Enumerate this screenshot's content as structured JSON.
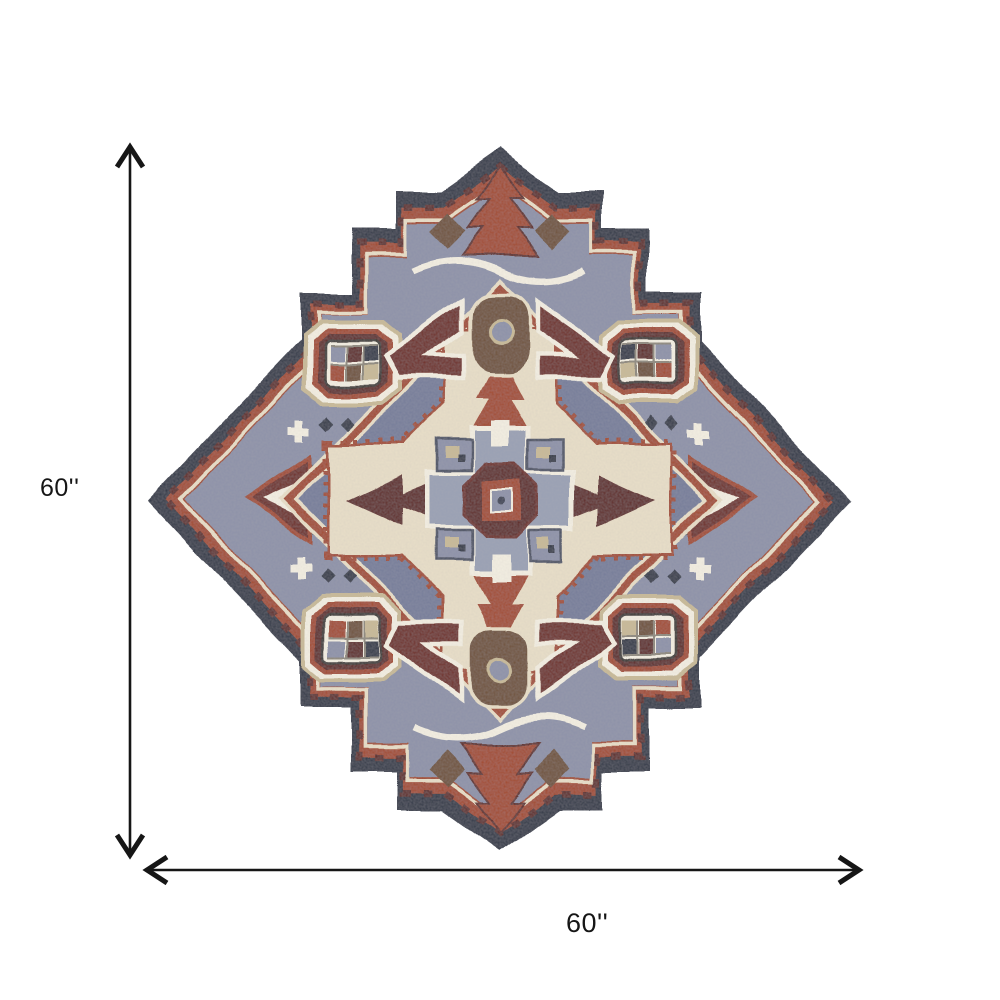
{
  "dimensions": {
    "height_label": "60''",
    "width_label": "60''"
  },
  "rug": {
    "style_name": "medallion-star-area-rug",
    "palette": {
      "navy": "#2e3445",
      "navydark": "#232a3a",
      "rust": "#a3492b",
      "rustlight": "#b85f35",
      "maroon": "#5f2620",
      "darkred": "#6e2a22",
      "cream": "#e9dfc8",
      "ivory": "#f4efe2",
      "grayblue": "#8d92a8",
      "graydark": "#767d9a",
      "graymid": "#9aa0b4",
      "brown": "#6f5138",
      "tan": "#c9ba96",
      "ink": "#161616"
    }
  }
}
